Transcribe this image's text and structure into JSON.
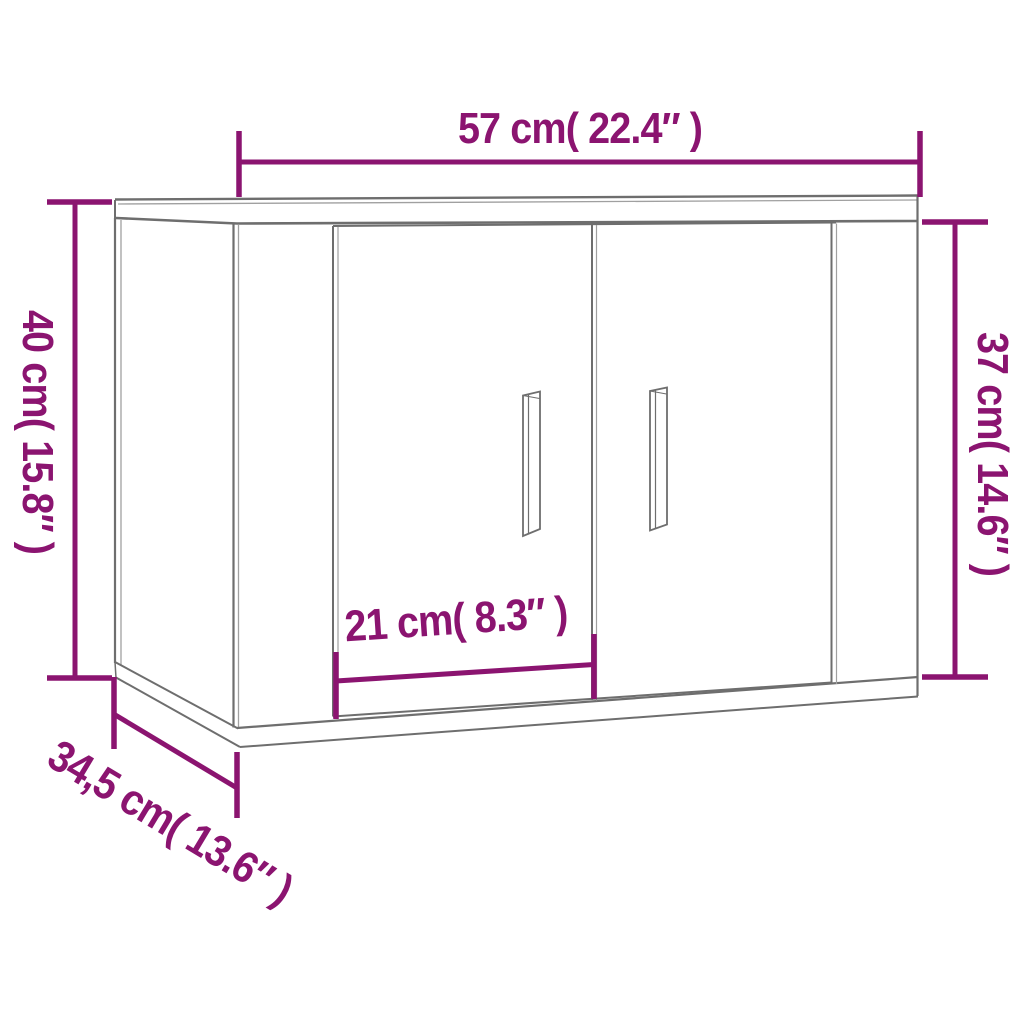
{
  "page": {
    "background_color": "#ffffff",
    "description": "Product dimension line drawing of a wall-mounted cabinet with two doors and two vertical handles, viewed from lower left"
  },
  "diagram": {
    "object": "wall-mounted two-door cabinet",
    "doors": 2,
    "handles": 2,
    "colors": {
      "dimension_accent": "#8b1470",
      "outline_gray": "#6e6e6e",
      "outline_gray_light": "#a0a0a0",
      "face_fill": "#ffffff"
    },
    "dimensions": {
      "width": {
        "label": "57 cm( 22.4″ )",
        "position": "top"
      },
      "height_left": {
        "label": "40 cm( 15.8″ )",
        "position": "left, rotated 90°"
      },
      "height_right": {
        "label": "37 cm( 14.6″ )",
        "position": "right, rotated 90°"
      },
      "door_width": {
        "label": "21 cm( 8.3″ )",
        "position": "lower front, on left door"
      },
      "depth": {
        "label": "34,5 cm( 13.6″ )",
        "position": "bottom left, diagonal"
      }
    }
  }
}
